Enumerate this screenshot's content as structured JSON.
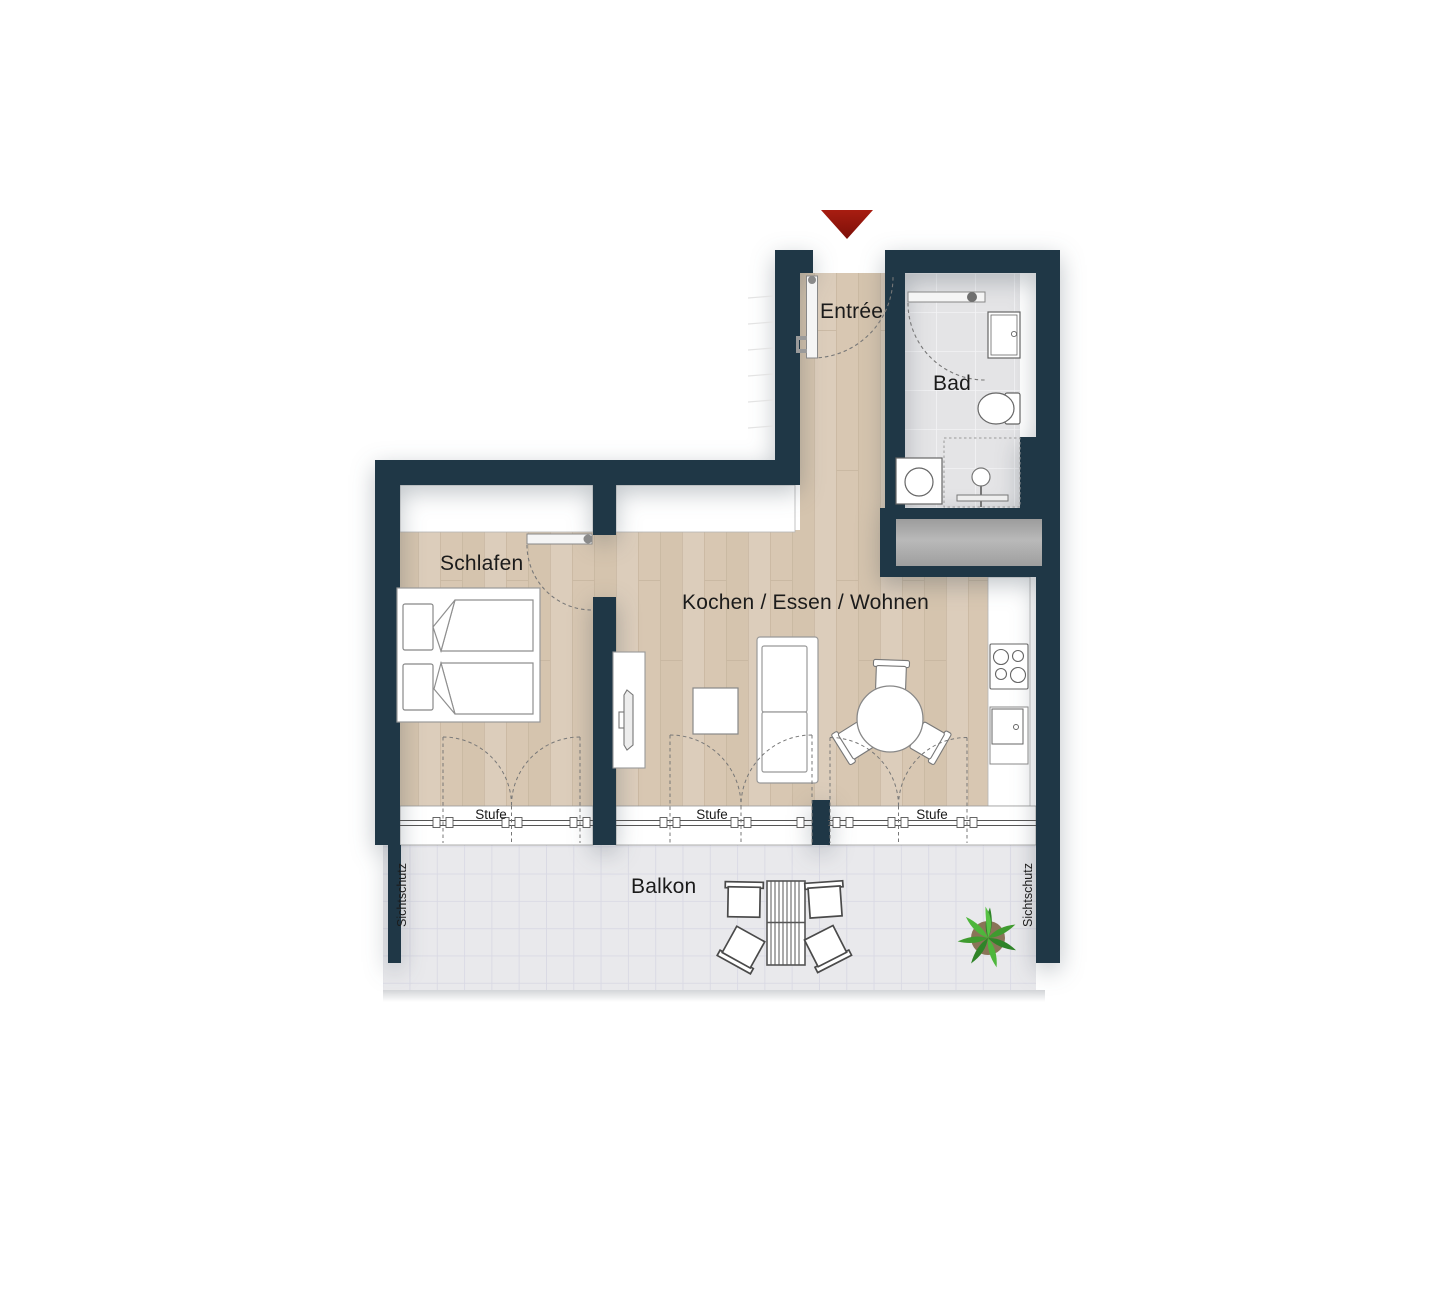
{
  "plan": {
    "type": "apartment-floor-plan",
    "rooms": {
      "entree": {
        "label": "Entrée"
      },
      "bad": {
        "label": "Bad"
      },
      "schlafen": {
        "label": "Schlafen"
      },
      "wohnen": {
        "label": "Kochen / Essen / Wohnen"
      },
      "balkon": {
        "label": "Balkon"
      }
    },
    "annotations": {
      "stufe": "Stufe",
      "sichtschutz": "Sichtschutz"
    },
    "icons": {
      "entrance_marker": "red-triangle-arrow-down"
    },
    "fixtures": [
      "bath-sink",
      "toilet",
      "shower",
      "washing-machine",
      "cooktop",
      "kitchen-sink-cabinet"
    ],
    "furniture": [
      "double-bed",
      "tv-sideboard",
      "coffee-table",
      "sofa",
      "round-dining-table",
      "three-dining-chairs",
      "balcony-slatted-table",
      "four-balcony-chairs",
      "potted-plant"
    ],
    "colors": {
      "wall": "#1f3746",
      "wood_floor": "#d9c9b6",
      "bath_tile": "#e4e4e6",
      "balcony_tile": "#e9e9ec",
      "shaft_gray": "#a8a8a8",
      "arrow_red": "#96150e",
      "plant_green": "#3f9b2f",
      "furniture_outline": "#8a8a8a",
      "label_text": "#1b1b1b"
    }
  }
}
